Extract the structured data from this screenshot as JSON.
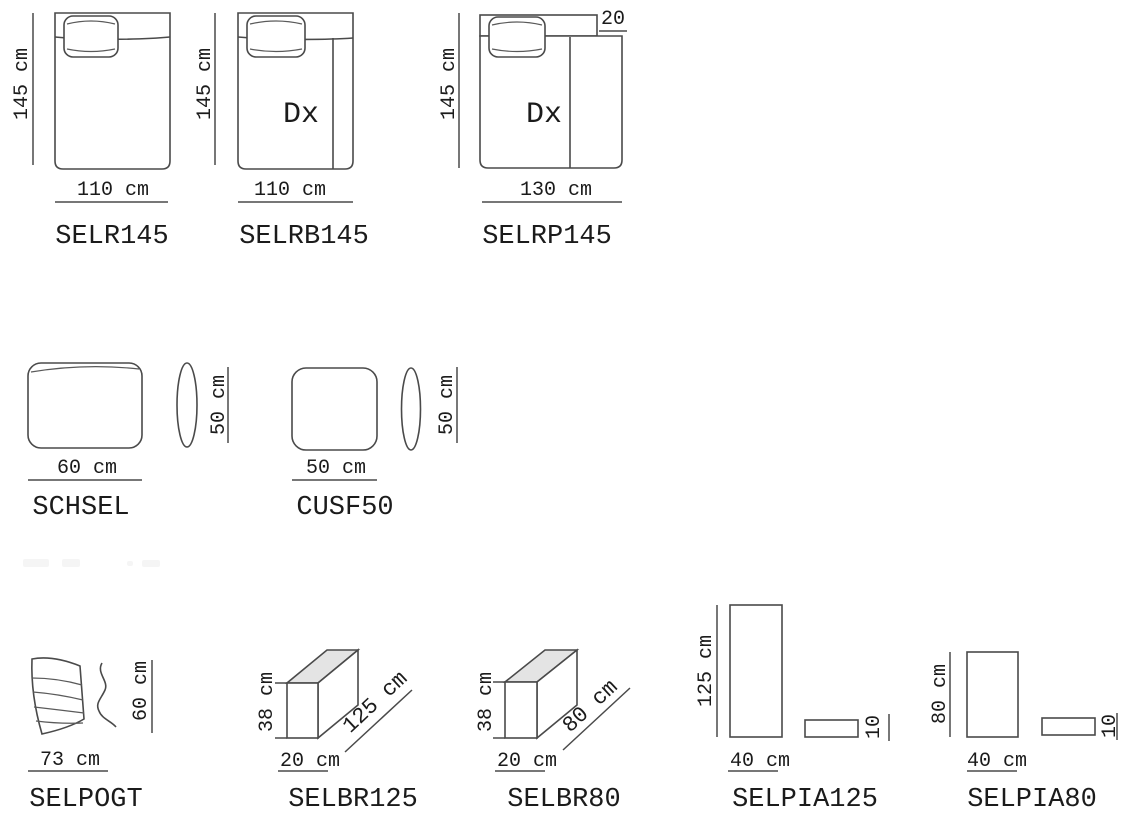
{
  "colors": {
    "background": "#ffffff",
    "line": "#4a4a4a",
    "text": "#1b1b1b",
    "top_face_shade": "#e4e4e4"
  },
  "row1": {
    "selr145": {
      "label": "SELR145",
      "width_dim": "110 cm",
      "height_dim": "145 cm"
    },
    "selrb145": {
      "label": "SELRB145",
      "width_dim": "110 cm",
      "height_dim": "145 cm",
      "side_mark": "Dx"
    },
    "selrp145": {
      "label": "SELRP145",
      "width_dim": "130 cm",
      "height_dim": "145 cm",
      "side_mark": "Dx",
      "back_offset_dim": "20"
    }
  },
  "row2": {
    "schsel": {
      "label": "SCHSEL",
      "width_dim": "60 cm",
      "height_dim": "50 cm"
    },
    "cusf50": {
      "label": "CUSF50",
      "width_dim": "50 cm",
      "height_dim": "50 cm"
    }
  },
  "row3": {
    "selpogt": {
      "label": "SELPOGT",
      "width_dim": "73 cm",
      "height_dim": "60 cm"
    },
    "selbr125": {
      "label": "SELBR125",
      "depth_dim": "20 cm",
      "height_dim": "38 cm",
      "length_dim": "125 cm"
    },
    "selbr80": {
      "label": "SELBR80",
      "depth_dim": "20 cm",
      "height_dim": "38 cm",
      "length_dim": "80 cm"
    },
    "selpia125": {
      "label": "SELPIA125",
      "width_dim": "40 cm",
      "height_dim": "125 cm",
      "thickness_dim": "10"
    },
    "selpia80": {
      "label": "SELPIA80",
      "width_dim": "40 cm",
      "height_dim": "80 cm",
      "thickness_dim": "10"
    }
  }
}
